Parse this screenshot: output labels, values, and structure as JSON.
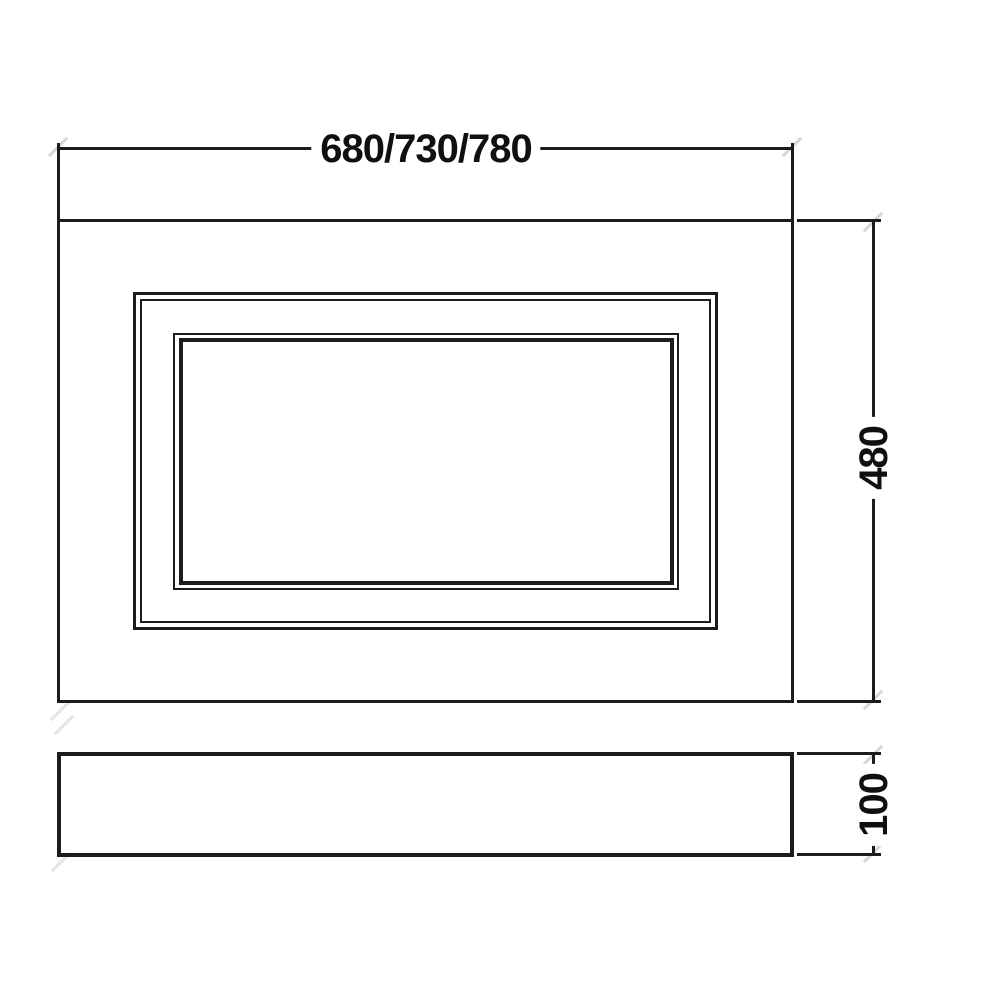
{
  "drawing": {
    "dimensions": {
      "panel_width": "680/730/780",
      "panel_height": "480",
      "plinth_height": "100"
    }
  },
  "colors": {
    "line": "#1c1c1c",
    "text": "#101010",
    "background": "#ffffff",
    "faint_tick": "#d7d7d7"
  }
}
